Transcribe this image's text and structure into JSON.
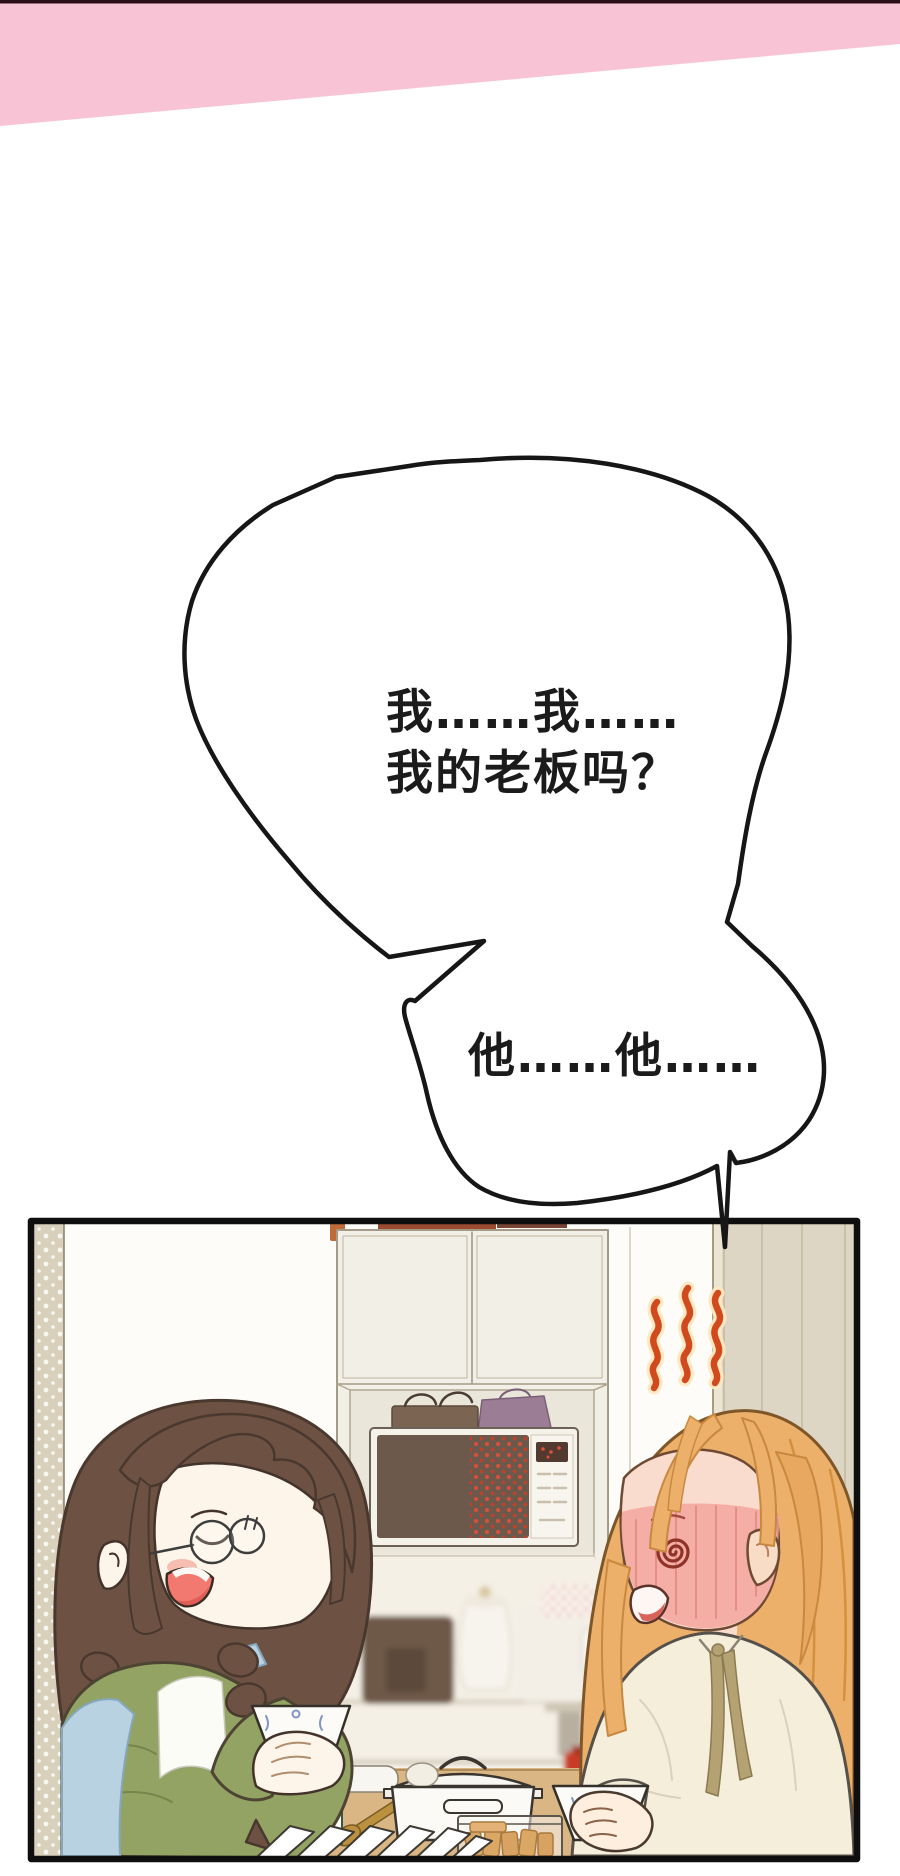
{
  "page": {
    "kind": "webtoon-comic-page",
    "width_px": 900,
    "height_px": 1876,
    "background_color": "#ffffff"
  },
  "top_banner": {
    "top_line_color": "#2b0d16",
    "band_color": "#f9c3d6"
  },
  "speech_bubbles": [
    {
      "name": "bubble-1",
      "line1": "我……我……",
      "line2": "我的老板吗？"
    },
    {
      "name": "bubble-2",
      "line1": "他……他……"
    }
  ],
  "panel": {
    "border_color": "#101010",
    "colors": {
      "heat_steam": "#d14a1e",
      "left_girl_hair": "#6d5244",
      "left_girl_sweater": "#93a363",
      "left_girl_apron": "#b9d2e2",
      "right_girl_hair": "#ecb06b",
      "right_girl_blouse": "#f4eedb",
      "blush": "#f2a39b",
      "wall_pillar": "#ded6c4",
      "microwave_face": "#6d594b",
      "table_wood": "#dab685"
    }
  }
}
